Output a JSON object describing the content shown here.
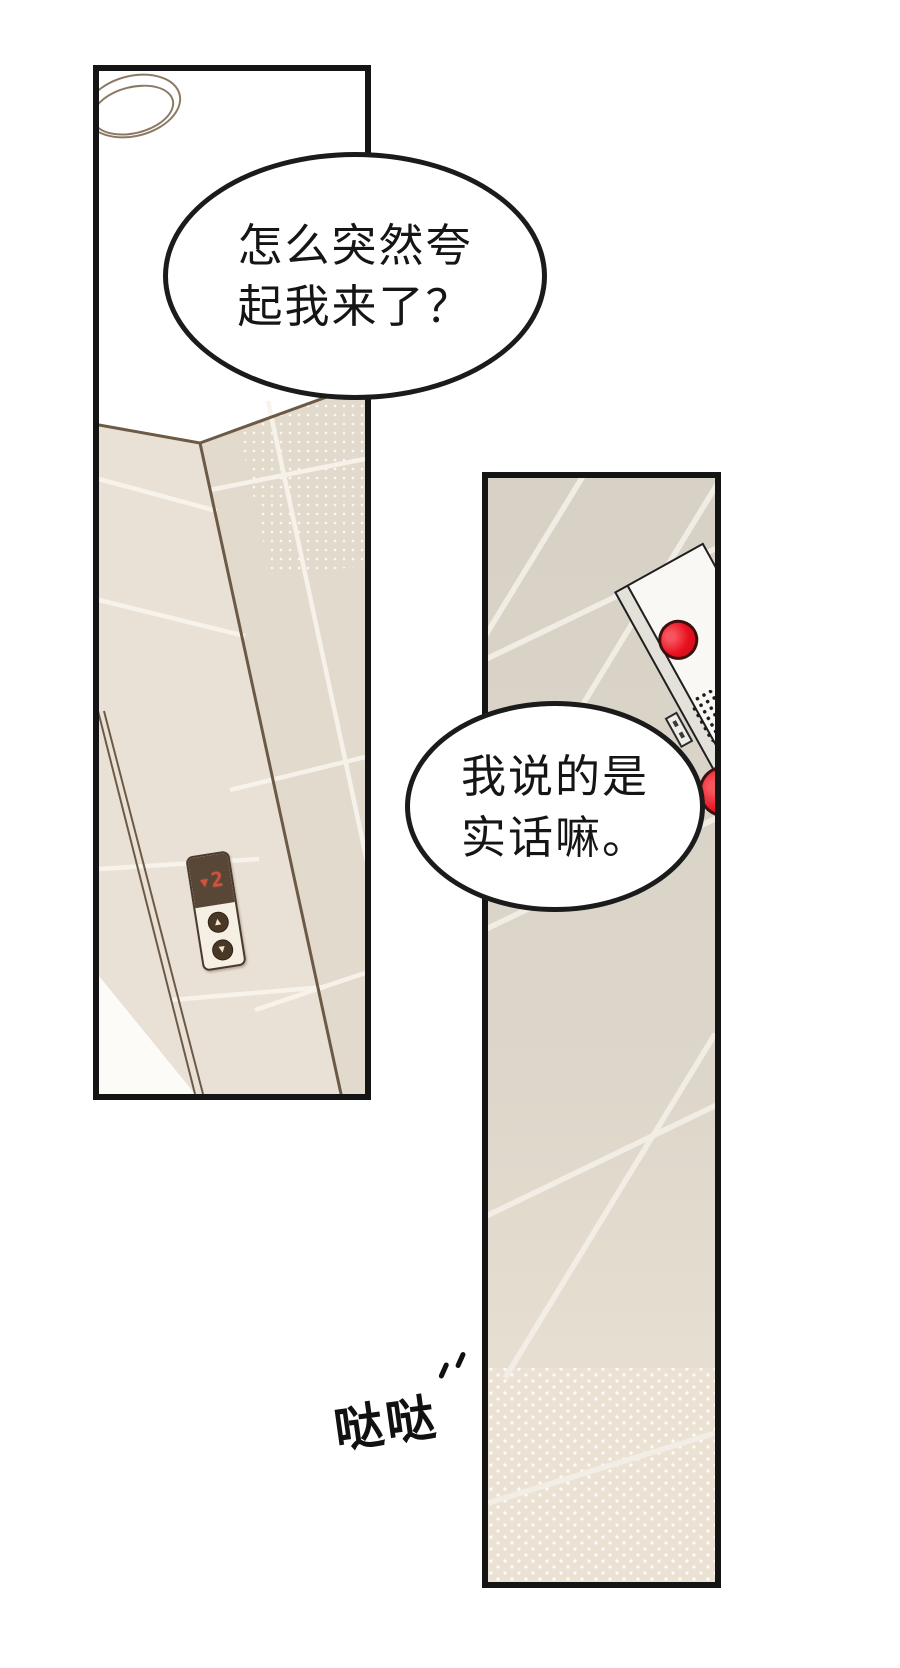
{
  "bubbles": [
    {
      "id": "bubble-1",
      "lines": [
        "怎么突然夸",
        "起我来了？"
      ]
    },
    {
      "id": "bubble-2",
      "lines": [
        "我说的是",
        "实话嘛。"
      ]
    }
  ],
  "sfx": {
    "text": "哒哒"
  },
  "elevator_panel": {
    "display": "▾2",
    "direction": "down",
    "floor": "2",
    "up_button": "▲",
    "down_button": "▼"
  },
  "colors": {
    "panel_border": "#141414",
    "tile_left_face": "#e9e1d6",
    "tile_left_face_dark": "#e2dacd",
    "tile_right_panel": "#d8d2c7",
    "tile_dotted_bottom": "#ebe2d3",
    "grout": "#f8f4ec",
    "wall_outline": "#6d5a46",
    "display_bg": "#584636",
    "display_led": "#d05340",
    "call_plate": "#f6efe3",
    "intercom_face": "#f9f8f4",
    "intercom_red": "#e8101f",
    "bubble_outline": "#1b1b1b"
  }
}
